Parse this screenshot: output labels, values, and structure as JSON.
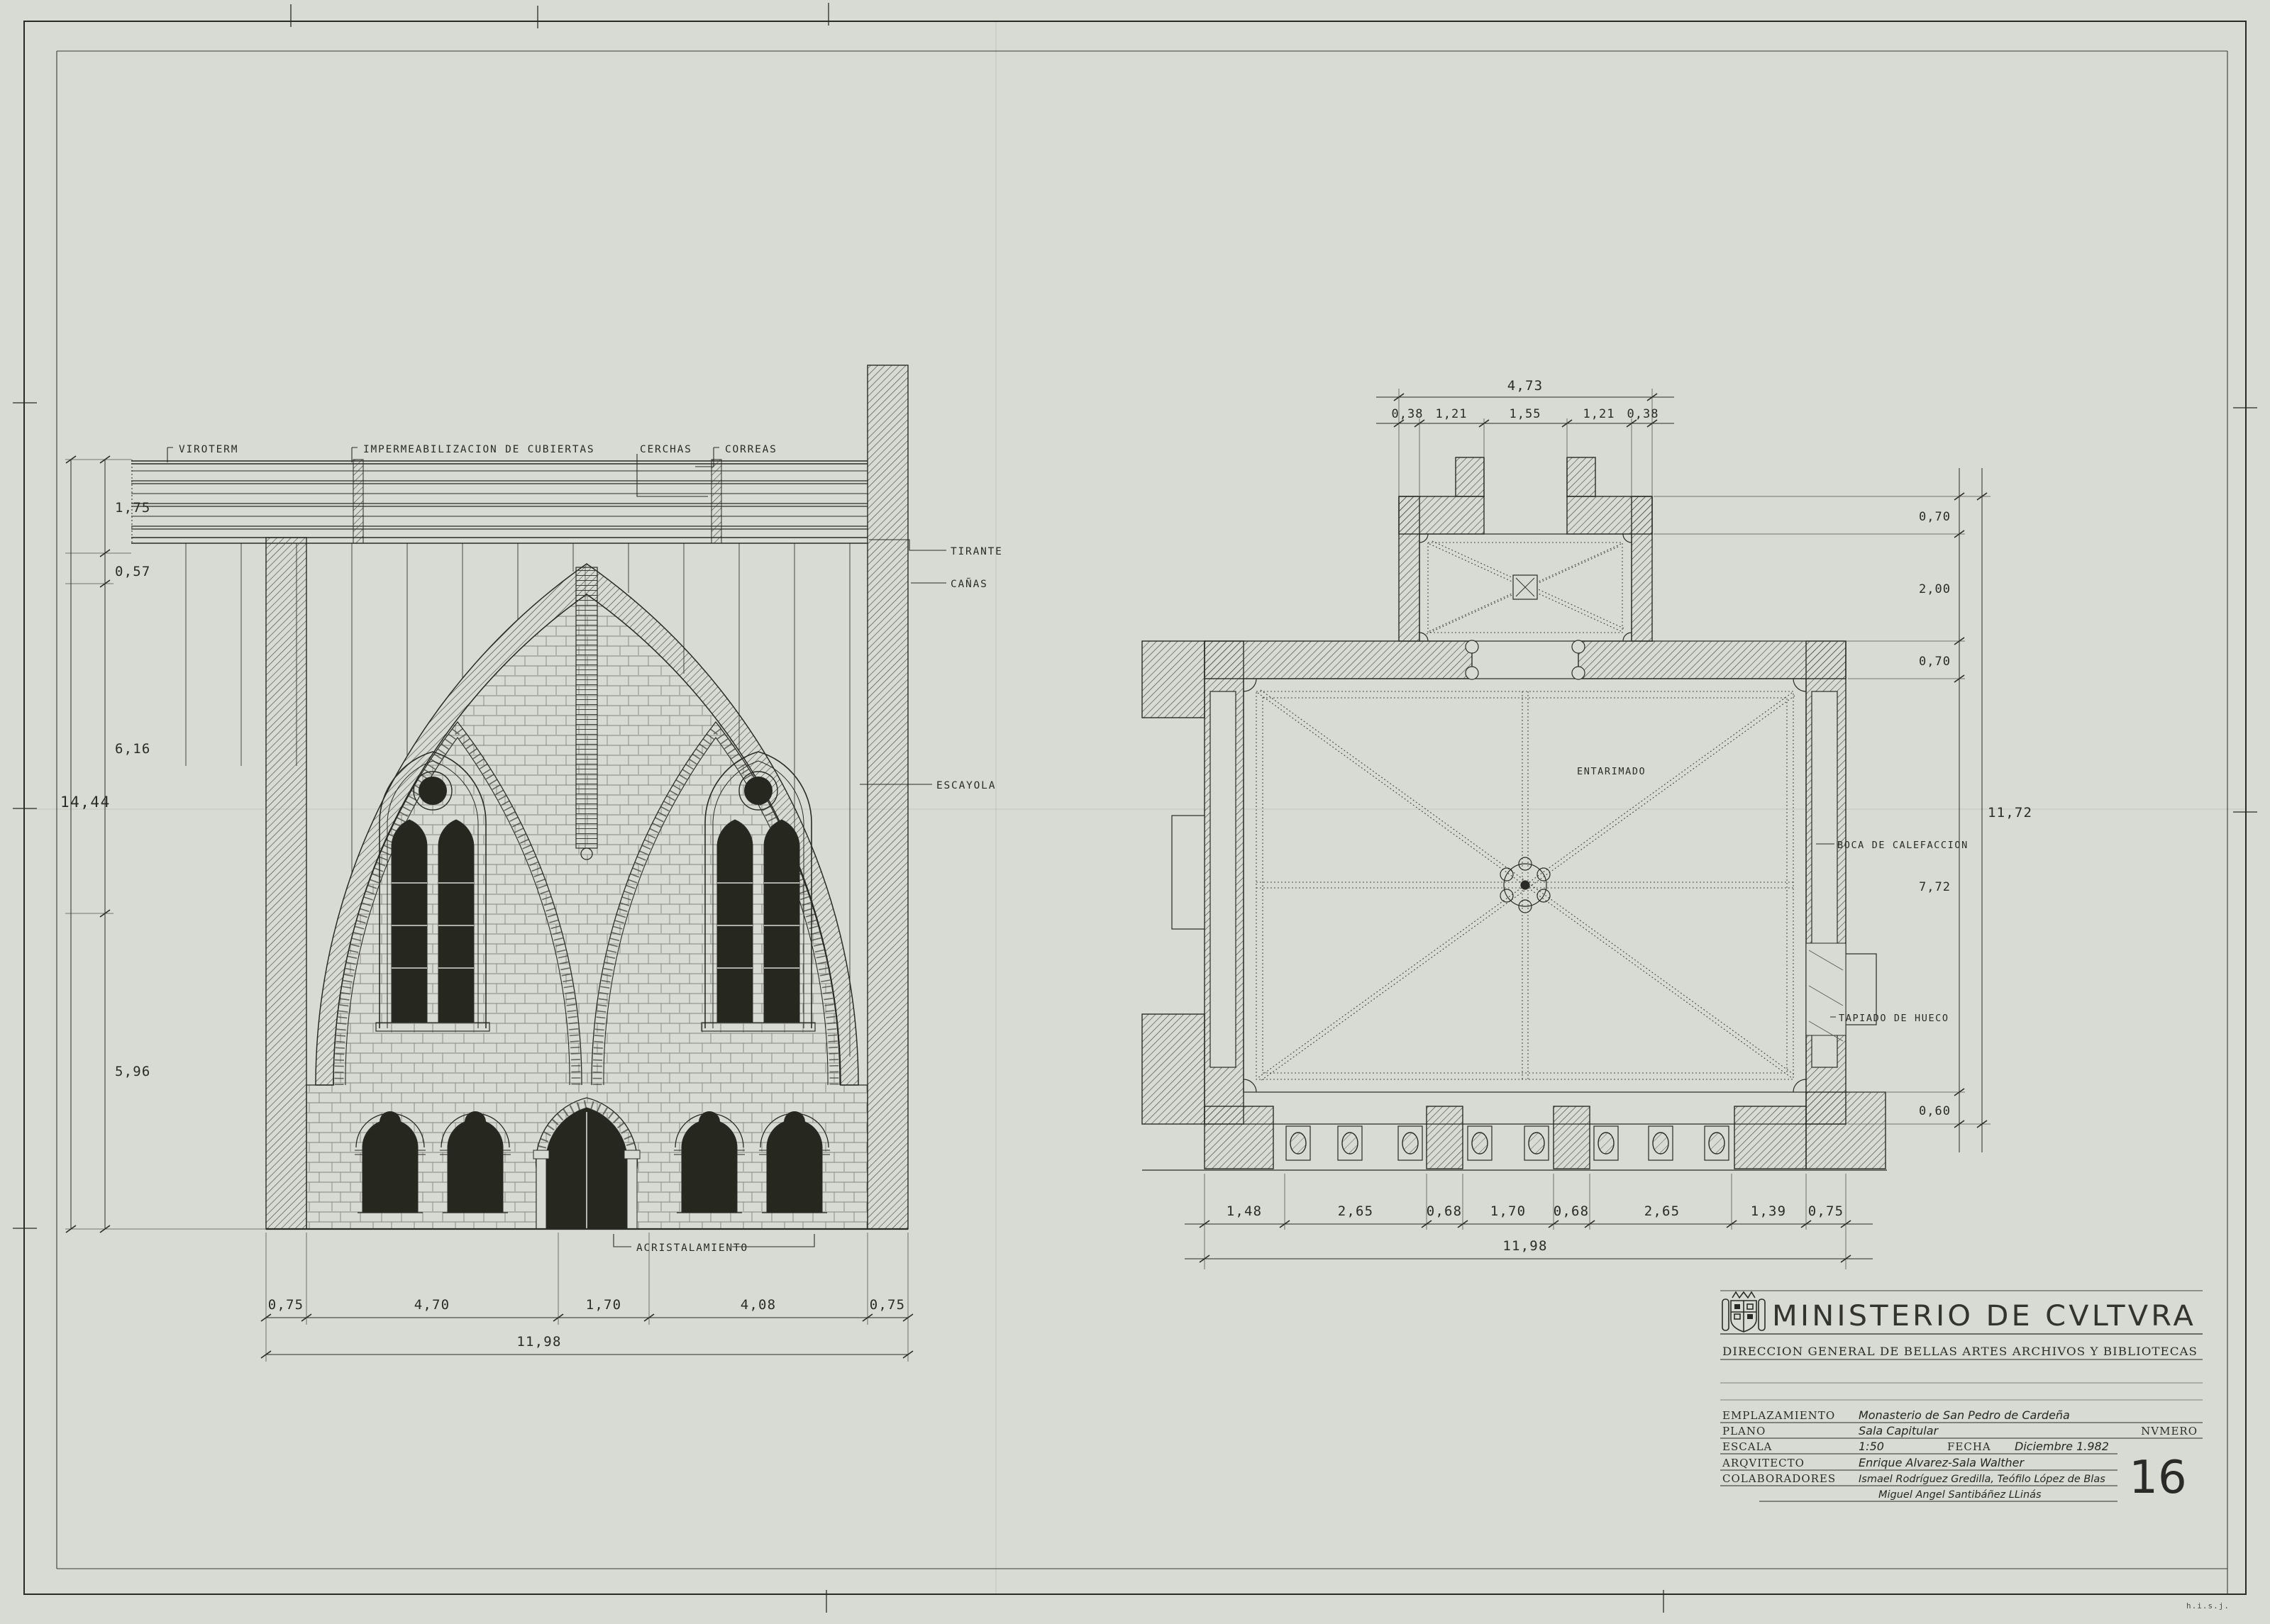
{
  "sheet": {
    "corner_mark": "h.i.s.j.",
    "palette": {
      "paper": "#d8dad4",
      "ink": "#2a2b28",
      "hatch": "#3b3c37",
      "stone": "#83847c"
    }
  },
  "section": {
    "callouts": {
      "viroterm": "VIROTERM",
      "impermeabilizacion": "IMPERMEABILIZACION DE CUBIERTAS",
      "cerchas": "CERCHAS",
      "correas": "CORREAS",
      "tirante": "TIRANTE",
      "canas": "CAÑAS",
      "escayola": "ESCAYOLA",
      "acristalamiento": "ACRISTALAMIENTO"
    },
    "dims_left": {
      "total": "14,44",
      "segments": [
        "1,75",
        "0,57",
        "6,16",
        "5,96"
      ]
    },
    "dims_bottom": {
      "total": "11,98",
      "segments": [
        "0,75",
        "4,70",
        "1,70",
        "4,08",
        "0,75"
      ]
    }
  },
  "plan": {
    "labels": {
      "entarimado": "ENTARIMADO",
      "boca_calefaccion": "BOCA DE CALEFACCION",
      "tapiado_hueco": "TAPIADO DE HUECO"
    },
    "dims_top": {
      "total": "4,73",
      "segments": [
        "0,38",
        "1,21",
        "1,55",
        "1,21",
        "0,38"
      ]
    },
    "dims_right": {
      "total": "11,72",
      "segments": [
        "0,70",
        "2,00",
        "0,70",
        "7,72",
        "0,60"
      ]
    },
    "dims_bottom": {
      "total": "11,98",
      "segments": [
        "1,48",
        "2,65",
        "0,68",
        "1,70",
        "0,68",
        "2,65",
        "1,39",
        "0,75"
      ]
    }
  },
  "title_block": {
    "ministry": "MINISTERIO DE CVLTVRA",
    "department": "DIRECCION GENERAL DE BELLAS ARTES ARCHIVOS Y BIBLIOTECAS",
    "fields": {
      "emplazamiento_label": "EMPLAZAMIENTO",
      "emplazamiento": "Monasterio de San Pedro de Cardeña",
      "plano_label": "PLANO",
      "plano": "Sala Capitular",
      "numero_label": "NVMERO",
      "numero": "16",
      "escala_label": "ESCALA",
      "escala": "1:50",
      "fecha_label": "FECHA",
      "fecha": "Diciembre 1.982",
      "arquitecto_label": "ARQVITECTO",
      "arquitecto": "Enrique Alvarez-Sala Walther",
      "colaboradores_label": "COLABORADORES",
      "colaboradores_1": "Ismael Rodríguez Gredilla, Teófilo López de Blas",
      "colaboradores_2": "Miguel Angel Santibáñez LLinás"
    }
  }
}
